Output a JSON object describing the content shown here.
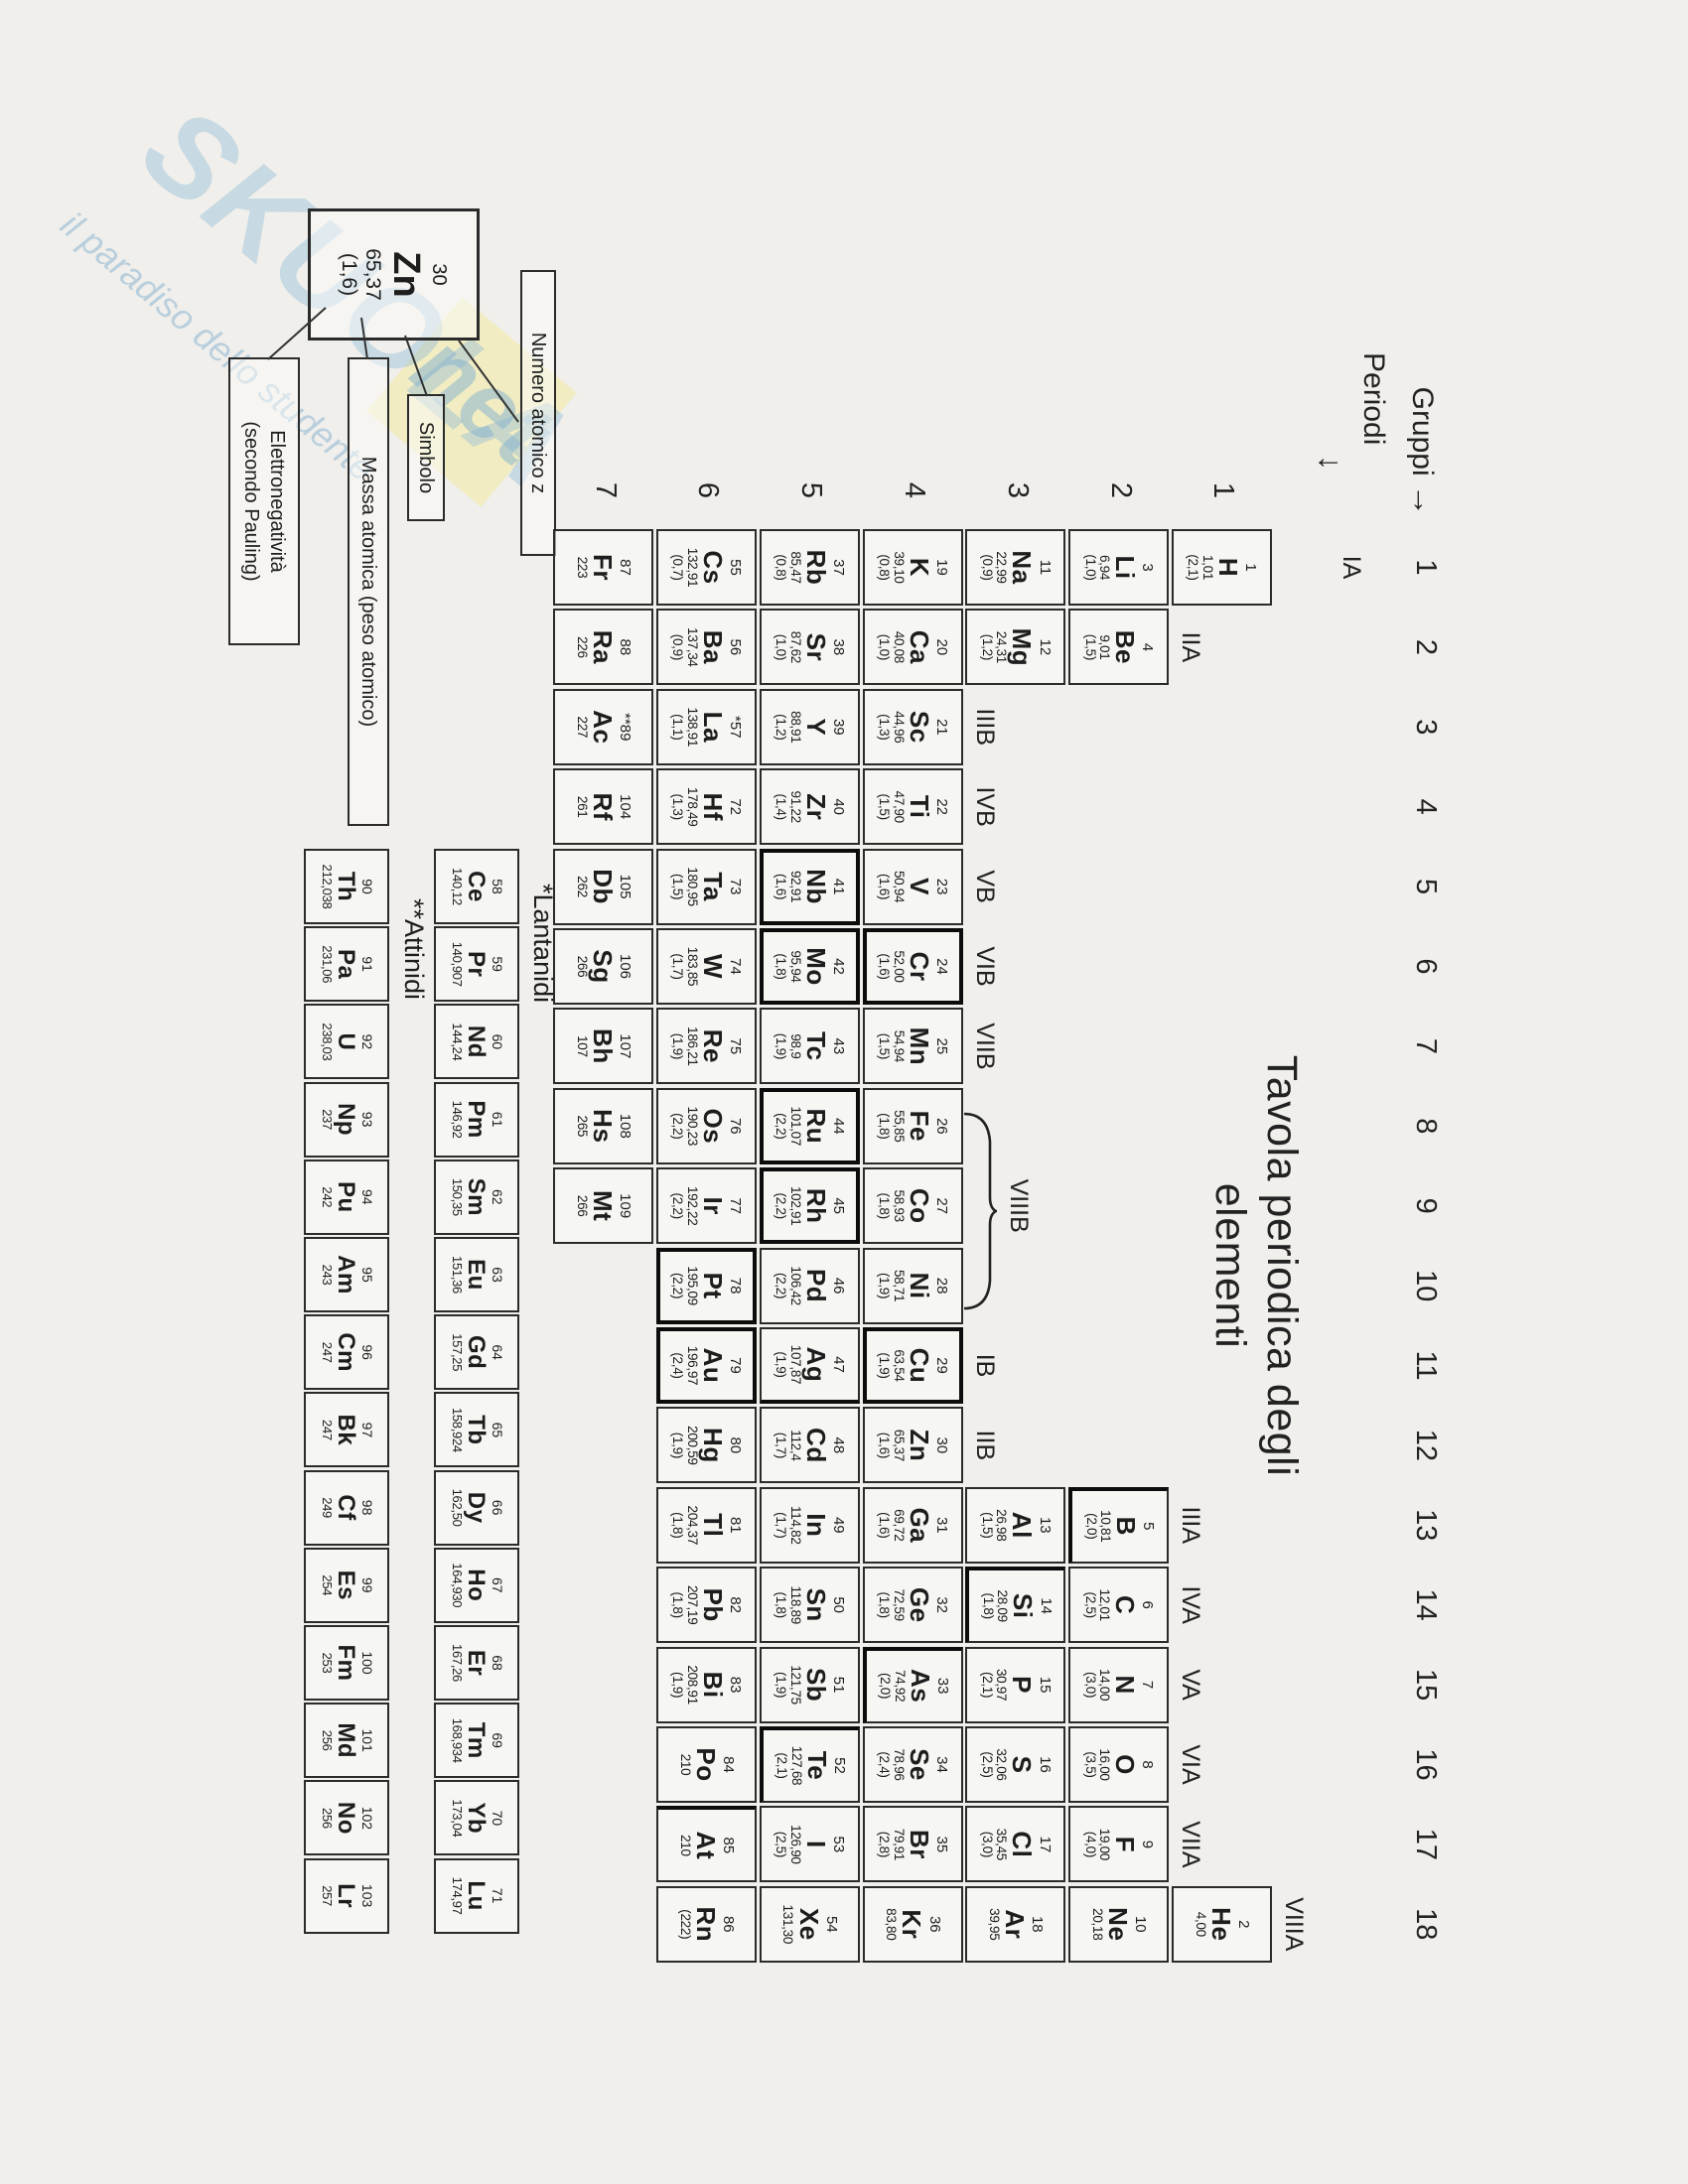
{
  "colors": {
    "paper": "#f0efeb",
    "ink": "#1d1d1d",
    "watermark_blue": "#90b9d6",
    "watermark_yellow": "#f3e9a0"
  },
  "header": {
    "gruppi_label": "Gruppi",
    "gruppi_arrow": "→",
    "periodi_label": "Periodi",
    "periodi_arrow": "↓",
    "group_numbers": [
      "1",
      "2",
      "3",
      "4",
      "5",
      "6",
      "7",
      "8",
      "9",
      "10",
      "11",
      "12",
      "13",
      "14",
      "15",
      "16",
      "17",
      "18"
    ],
    "period_numbers": [
      "1",
      "2",
      "3",
      "4",
      "5",
      "6",
      "7"
    ]
  },
  "group_labels": [
    {
      "text": "IA",
      "group": 1
    },
    {
      "text": "IIA",
      "group": 2
    },
    {
      "text": "IIIB",
      "group": 3
    },
    {
      "text": "IVB",
      "group": 4
    },
    {
      "text": "VB",
      "group": 5
    },
    {
      "text": "VIB",
      "group": 6
    },
    {
      "text": "VIIB",
      "group": 7
    },
    {
      "text": "VIIIB",
      "span": [
        8,
        10
      ]
    },
    {
      "text": "IB",
      "group": 11
    },
    {
      "text": "IIB",
      "group": 12
    },
    {
      "text": "IIIA",
      "group": 13
    },
    {
      "text": "IVA",
      "group": 14
    },
    {
      "text": "VA",
      "group": 15
    },
    {
      "text": "VIA",
      "group": 16
    },
    {
      "text": "VIIA",
      "group": 17
    },
    {
      "text": "VIIIA",
      "group": 18
    }
  ],
  "title": {
    "line1": "Tavola periodica degli",
    "line2": "elementi"
  },
  "legend": {
    "cell": {
      "z": "30",
      "sym": "Zn",
      "mass": "65,37",
      "en": "(1,6)"
    },
    "numero_label": "Numero atomico z",
    "simbolo_label": "Simbolo",
    "massa_label": "Massa atomica (peso atomico)",
    "elettro_label_line1": "Elettronegatività",
    "elettro_label_line2": "(secondo Pauling)"
  },
  "series_labels": {
    "lanthanides": "*Lantanidi",
    "actinides": "**Attinidi"
  },
  "watermark": {
    "big": "SKUOLA",
    "net": "net",
    "tagline": "il paradiso dello studente"
  },
  "elements": [
    {
      "z": "1",
      "s": "H",
      "m": "1,01",
      "e": "(2,1)",
      "g": 1,
      "p": 1
    },
    {
      "z": "2",
      "s": "He",
      "m": "4,00",
      "e": "",
      "g": 18,
      "p": 1
    },
    {
      "z": "3",
      "s": "Li",
      "m": "6,94",
      "e": "(1,0)",
      "g": 1,
      "p": 2
    },
    {
      "z": "4",
      "s": "Be",
      "m": "9,01",
      "e": "(1,5)",
      "g": 2,
      "p": 2
    },
    {
      "z": "5",
      "s": "B",
      "m": "10,81",
      "e": "(2,0)",
      "g": 13,
      "p": 2,
      "be": "lb"
    },
    {
      "z": "6",
      "s": "C",
      "m": "12,01",
      "e": "(2,5)",
      "g": 14,
      "p": 2
    },
    {
      "z": "7",
      "s": "N",
      "m": "14,00",
      "e": "(3,0)",
      "g": 15,
      "p": 2
    },
    {
      "z": "8",
      "s": "O",
      "m": "16,00",
      "e": "(3,5)",
      "g": 16,
      "p": 2
    },
    {
      "z": "9",
      "s": "F",
      "m": "19,00",
      "e": "(4,0)",
      "g": 17,
      "p": 2
    },
    {
      "z": "10",
      "s": "Ne",
      "m": "20,18",
      "e": "",
      "g": 18,
      "p": 2
    },
    {
      "z": "11",
      "s": "Na",
      "m": "22,99",
      "e": "(0,9)",
      "g": 1,
      "p": 3
    },
    {
      "z": "12",
      "s": "Mg",
      "m": "24,31",
      "e": "(1,2)",
      "g": 2,
      "p": 3
    },
    {
      "z": "13",
      "s": "Al",
      "m": "26,98",
      "e": "(1,5)",
      "g": 13,
      "p": 3
    },
    {
      "z": "14",
      "s": "Si",
      "m": "28,09",
      "e": "(1,8)",
      "g": 14,
      "p": 3,
      "be": "lb"
    },
    {
      "z": "15",
      "s": "P",
      "m": "30,97",
      "e": "(2,1)",
      "g": 15,
      "p": 3
    },
    {
      "z": "16",
      "s": "S",
      "m": "32,06",
      "e": "(2,5)",
      "g": 16,
      "p": 3
    },
    {
      "z": "17",
      "s": "Cl",
      "m": "35,45",
      "e": "(3,0)",
      "g": 17,
      "p": 3
    },
    {
      "z": "18",
      "s": "Ar",
      "m": "39,95",
      "e": "",
      "g": 18,
      "p": 3
    },
    {
      "z": "19",
      "s": "K",
      "m": "39,10",
      "e": "(0,8)",
      "g": 1,
      "p": 4
    },
    {
      "z": "20",
      "s": "Ca",
      "m": "40,08",
      "e": "(1,0)",
      "g": 2,
      "p": 4
    },
    {
      "z": "21",
      "s": "Sc",
      "m": "44,96",
      "e": "(1,3)",
      "g": 3,
      "p": 4
    },
    {
      "z": "22",
      "s": "Ti",
      "m": "47,90",
      "e": "(1,5)",
      "g": 4,
      "p": 4
    },
    {
      "z": "23",
      "s": "V",
      "m": "50,94",
      "e": "(1,6)",
      "g": 5,
      "p": 4
    },
    {
      "z": "24",
      "s": "Cr",
      "m": "52,00",
      "e": "(1,6)",
      "g": 6,
      "p": 4,
      "b": true
    },
    {
      "z": "25",
      "s": "Mn",
      "m": "54,94",
      "e": "(1,5)",
      "g": 7,
      "p": 4
    },
    {
      "z": "26",
      "s": "Fe",
      "m": "55,85",
      "e": "(1,8)",
      "g": 8,
      "p": 4
    },
    {
      "z": "27",
      "s": "Co",
      "m": "58,93",
      "e": "(1,8)",
      "g": 9,
      "p": 4
    },
    {
      "z": "28",
      "s": "Ni",
      "m": "58,71",
      "e": "(1,9)",
      "g": 10,
      "p": 4
    },
    {
      "z": "29",
      "s": "Cu",
      "m": "63,54",
      "e": "(1,9)",
      "g": 11,
      "p": 4,
      "b": true
    },
    {
      "z": "30",
      "s": "Zn",
      "m": "65,37",
      "e": "(1,6)",
      "g": 12,
      "p": 4
    },
    {
      "z": "31",
      "s": "Ga",
      "m": "69,72",
      "e": "(1,6)",
      "g": 13,
      "p": 4
    },
    {
      "z": "32",
      "s": "Ge",
      "m": "72,59",
      "e": "(1,8)",
      "g": 14,
      "p": 4
    },
    {
      "z": "33",
      "s": "As",
      "m": "74,92",
      "e": "(2,0)",
      "g": 15,
      "p": 4,
      "be": "lb"
    },
    {
      "z": "34",
      "s": "Se",
      "m": "78,96",
      "e": "(2,4)",
      "g": 16,
      "p": 4
    },
    {
      "z": "35",
      "s": "Br",
      "m": "79,91",
      "e": "(2,8)",
      "g": 17,
      "p": 4
    },
    {
      "z": "36",
      "s": "Kr",
      "m": "83,80",
      "e": "",
      "g": 18,
      "p": 4
    },
    {
      "z": "37",
      "s": "Rb",
      "m": "85,47",
      "e": "(0,8)",
      "g": 1,
      "p": 5
    },
    {
      "z": "38",
      "s": "Sr",
      "m": "87,62",
      "e": "(1,0)",
      "g": 2,
      "p": 5
    },
    {
      "z": "39",
      "s": "Y",
      "m": "88,91",
      "e": "(1,2)",
      "g": 3,
      "p": 5
    },
    {
      "z": "40",
      "s": "Zr",
      "m": "91,22",
      "e": "(1,4)",
      "g": 4,
      "p": 5
    },
    {
      "z": "41",
      "s": "Nb",
      "m": "92,91",
      "e": "(1,6)",
      "g": 5,
      "p": 5,
      "b": true
    },
    {
      "z": "42",
      "s": "Mo",
      "m": "95,94",
      "e": "(1,8)",
      "g": 6,
      "p": 5,
      "b": true
    },
    {
      "z": "43",
      "s": "Tc",
      "m": "98,9",
      "e": "(1,9)",
      "g": 7,
      "p": 5
    },
    {
      "z": "44",
      "s": "Ru",
      "m": "101,07",
      "e": "(2,2)",
      "g": 8,
      "p": 5,
      "b": true
    },
    {
      "z": "45",
      "s": "Rh",
      "m": "102,91",
      "e": "(2,2)",
      "g": 9,
      "p": 5,
      "b": true
    },
    {
      "z": "46",
      "s": "Pd",
      "m": "106,42",
      "e": "(2,2)",
      "g": 10,
      "p": 5
    },
    {
      "z": "47",
      "s": "Ag",
      "m": "107,87",
      "e": "(1,9)",
      "g": 11,
      "p": 5,
      "be": "r"
    },
    {
      "z": "48",
      "s": "Cd",
      "m": "112,4",
      "e": "(1,7)",
      "g": 12,
      "p": 5
    },
    {
      "z": "49",
      "s": "In",
      "m": "114,82",
      "e": "(1,7)",
      "g": 13,
      "p": 5
    },
    {
      "z": "50",
      "s": "Sn",
      "m": "118,89",
      "e": "(1,8)",
      "g": 14,
      "p": 5
    },
    {
      "z": "51",
      "s": "Sb",
      "m": "121,75",
      "e": "(1,9)",
      "g": 15,
      "p": 5
    },
    {
      "z": "52",
      "s": "Te",
      "m": "127,68",
      "e": "(2,1)",
      "g": 16,
      "p": 5,
      "be": "lb"
    },
    {
      "z": "53",
      "s": "I",
      "m": "126,90",
      "e": "(2,5)",
      "g": 17,
      "p": 5
    },
    {
      "z": "54",
      "s": "Xe",
      "m": "131,30",
      "e": "",
      "g": 18,
      "p": 5
    },
    {
      "z": "55",
      "s": "Cs",
      "m": "132,91",
      "e": "(0,7)",
      "g": 1,
      "p": 6
    },
    {
      "z": "56",
      "s": "Ba",
      "m": "137,34",
      "e": "(0,9)",
      "g": 2,
      "p": 6
    },
    {
      "z": "*57",
      "s": "La",
      "m": "138,91",
      "e": "(1,1)",
      "g": 3,
      "p": 6
    },
    {
      "z": "72",
      "s": "Hf",
      "m": "178,49",
      "e": "(1,3)",
      "g": 4,
      "p": 6
    },
    {
      "z": "73",
      "s": "Ta",
      "m": "180,95",
      "e": "(1,5)",
      "g": 5,
      "p": 6
    },
    {
      "z": "74",
      "s": "W",
      "m": "183,85",
      "e": "(1,7)",
      "g": 6,
      "p": 6
    },
    {
      "z": "75",
      "s": "Re",
      "m": "186,21",
      "e": "(1,9)",
      "g": 7,
      "p": 6
    },
    {
      "z": "76",
      "s": "Os",
      "m": "190,23",
      "e": "(2,2)",
      "g": 8,
      "p": 6
    },
    {
      "z": "77",
      "s": "Ir",
      "m": "192,22",
      "e": "(2,2)",
      "g": 9,
      "p": 6
    },
    {
      "z": "78",
      "s": "Pt",
      "m": "195,09",
      "e": "(2,2)",
      "g": 10,
      "p": 6,
      "b": true
    },
    {
      "z": "79",
      "s": "Au",
      "m": "196,97",
      "e": "(2,4)",
      "g": 11,
      "p": 6,
      "b": true
    },
    {
      "z": "80",
      "s": "Hg",
      "m": "200,59",
      "e": "(1,9)",
      "g": 12,
      "p": 6
    },
    {
      "z": "81",
      "s": "Tl",
      "m": "204,37",
      "e": "(1,8)",
      "g": 13,
      "p": 6
    },
    {
      "z": "82",
      "s": "Pb",
      "m": "207,19",
      "e": "(1,8)",
      "g": 14,
      "p": 6
    },
    {
      "z": "83",
      "s": "Bi",
      "m": "208,91",
      "e": "(1,9)",
      "g": 15,
      "p": 6
    },
    {
      "z": "84",
      "s": "Po",
      "m": "210",
      "e": "",
      "g": 16,
      "p": 6
    },
    {
      "z": "85",
      "s": "At",
      "m": "210",
      "e": "",
      "g": 17,
      "p": 6,
      "be": "l"
    },
    {
      "z": "86",
      "s": "Rn",
      "m": "(222)",
      "e": "",
      "g": 18,
      "p": 6
    },
    {
      "z": "87",
      "s": "Fr",
      "m": "223",
      "e": "",
      "g": 1,
      "p": 7
    },
    {
      "z": "88",
      "s": "Ra",
      "m": "226",
      "e": "",
      "g": 2,
      "p": 7
    },
    {
      "z": "**89",
      "s": "Ac",
      "m": "227",
      "e": "",
      "g": 3,
      "p": 7
    },
    {
      "z": "104",
      "s": "Rf",
      "m": "261",
      "e": "",
      "g": 4,
      "p": 7
    },
    {
      "z": "105",
      "s": "Db",
      "m": "262",
      "e": "",
      "g": 5,
      "p": 7
    },
    {
      "z": "106",
      "s": "Sg",
      "m": "266",
      "e": "",
      "g": 6,
      "p": 7
    },
    {
      "z": "107",
      "s": "Bh",
      "m": "107",
      "e": "",
      "g": 7,
      "p": 7
    },
    {
      "z": "108",
      "s": "Hs",
      "m": "265",
      "e": "",
      "g": 8,
      "p": 7
    },
    {
      "z": "109",
      "s": "Mt",
      "m": "266",
      "e": "",
      "g": 9,
      "p": 7
    }
  ],
  "lanthanides": [
    {
      "z": "58",
      "s": "Ce",
      "m": "140,12"
    },
    {
      "z": "59",
      "s": "Pr",
      "m": "140,907"
    },
    {
      "z": "60",
      "s": "Nd",
      "m": "144,24"
    },
    {
      "z": "61",
      "s": "Pm",
      "m": "146,92"
    },
    {
      "z": "62",
      "s": "Sm",
      "m": "150,35"
    },
    {
      "z": "63",
      "s": "Eu",
      "m": "151,36"
    },
    {
      "z": "64",
      "s": "Gd",
      "m": "157,25"
    },
    {
      "z": "65",
      "s": "Tb",
      "m": "158,924"
    },
    {
      "z": "66",
      "s": "Dy",
      "m": "162,50"
    },
    {
      "z": "67",
      "s": "Ho",
      "m": "164,930"
    },
    {
      "z": "68",
      "s": "Er",
      "m": "167,26"
    },
    {
      "z": "69",
      "s": "Tm",
      "m": "168,934"
    },
    {
      "z": "70",
      "s": "Yb",
      "m": "173,04"
    },
    {
      "z": "71",
      "s": "Lu",
      "m": "174,97"
    }
  ],
  "actinides": [
    {
      "z": "90",
      "s": "Th",
      "m": "212,038"
    },
    {
      "z": "91",
      "s": "Pa",
      "m": "231,06"
    },
    {
      "z": "92",
      "s": "U",
      "m": "238,03"
    },
    {
      "z": "93",
      "s": "Np",
      "m": "237"
    },
    {
      "z": "94",
      "s": "Pu",
      "m": "242"
    },
    {
      "z": "95",
      "s": "Am",
      "m": "243"
    },
    {
      "z": "96",
      "s": "Cm",
      "m": "247"
    },
    {
      "z": "97",
      "s": "Bk",
      "m": "247"
    },
    {
      "z": "98",
      "s": "Cf",
      "m": "249"
    },
    {
      "z": "99",
      "s": "Es",
      "m": "254"
    },
    {
      "z": "100",
      "s": "Fm",
      "m": "253"
    },
    {
      "z": "101",
      "s": "Md",
      "m": "256"
    },
    {
      "z": "102",
      "s": "No",
      "m": "256"
    },
    {
      "z": "103",
      "s": "Lr",
      "m": "257"
    }
  ]
}
